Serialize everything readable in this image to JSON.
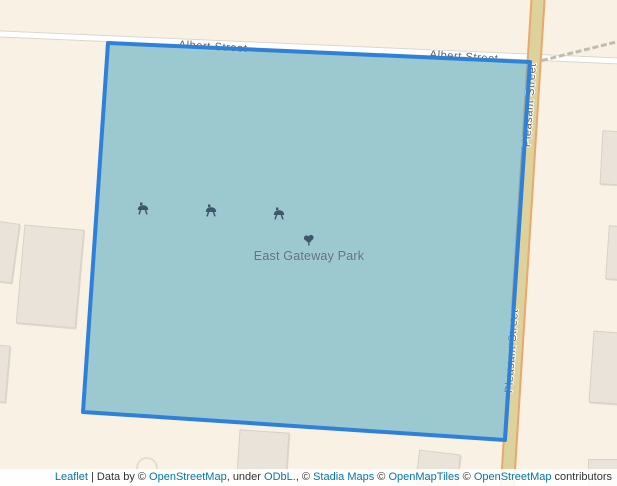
{
  "map": {
    "streets": {
      "albert": "Albert Street",
      "pleasant": "Pleasant Street"
    },
    "park": {
      "name": "East Gateway Park",
      "icons": [
        "bbq-grill",
        "bbq-grill",
        "bbq-grill",
        "tree"
      ]
    },
    "colors": {
      "background": "#f8f1e4",
      "park_fill": "#51a6bf",
      "park_fill_opacity": "0.55",
      "park_stroke": "#2f80d9",
      "road_minor_fill": "#ffffff",
      "road_tertiary_fill": "#ddd29b",
      "road_tertiary_casing": "#eaa76e",
      "building_fill": "#e9e3da",
      "street_label_color": "#5e5e5e",
      "park_label_color": "#5d7384",
      "poi_icon_color": "#3f566b",
      "link_color": "#0078a8"
    }
  },
  "attribution": {
    "segments": [
      {
        "text": "Leaflet",
        "link": true
      },
      {
        "text": " | Data by © ",
        "link": false
      },
      {
        "text": "OpenStreetMap",
        "link": true
      },
      {
        "text": ", under ",
        "link": false
      },
      {
        "text": "ODbL.",
        "link": true
      },
      {
        "text": ", © ",
        "link": false
      },
      {
        "text": "Stadia Maps",
        "link": true
      },
      {
        "text": " © ",
        "link": false
      },
      {
        "text": "OpenMapTiles",
        "link": true
      },
      {
        "text": " © ",
        "link": false
      },
      {
        "text": "OpenStreetMap",
        "link": true
      },
      {
        "text": " contributors",
        "link": false
      }
    ]
  }
}
